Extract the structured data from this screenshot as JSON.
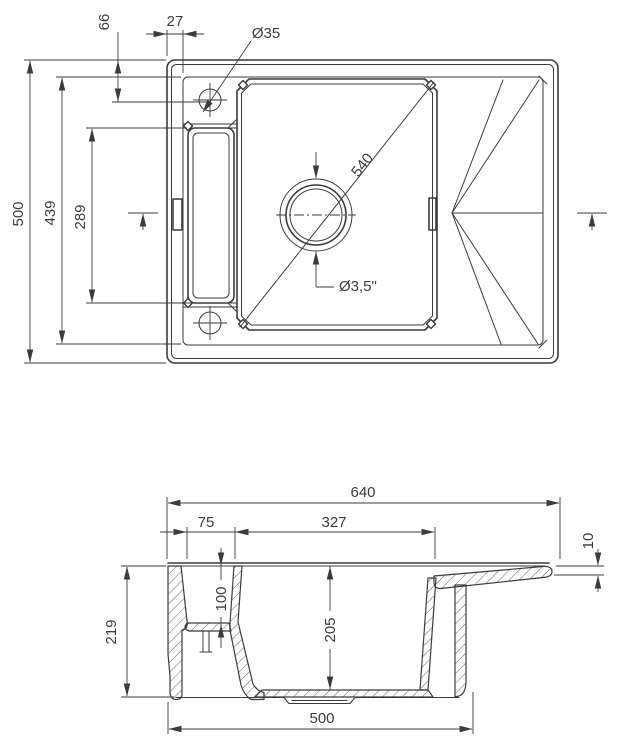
{
  "drawing": {
    "description": "sink-technical-drawing",
    "top_view": {
      "dim_tap_vertical": "66",
      "dim_rim_width": "27",
      "dim_tap_hole": "Ø35",
      "dim_overall_depth": "500",
      "dim_inner_depth": "439",
      "dim_recess_length": "289",
      "dim_bowl_diagonal": "540",
      "dim_drain": "Ø3,5\""
    },
    "section_view": {
      "dim_overall_width": "640",
      "dim_tray_width": "75",
      "dim_bowl_width": "327",
      "dim_edge_thickness": "10",
      "dim_tray_depth": "100",
      "dim_bowl_depth": "205",
      "dim_overall_height": "219",
      "dim_base_width": "500"
    },
    "colors": {
      "line": "#3c3c3c",
      "background": "#ffffff"
    }
  }
}
